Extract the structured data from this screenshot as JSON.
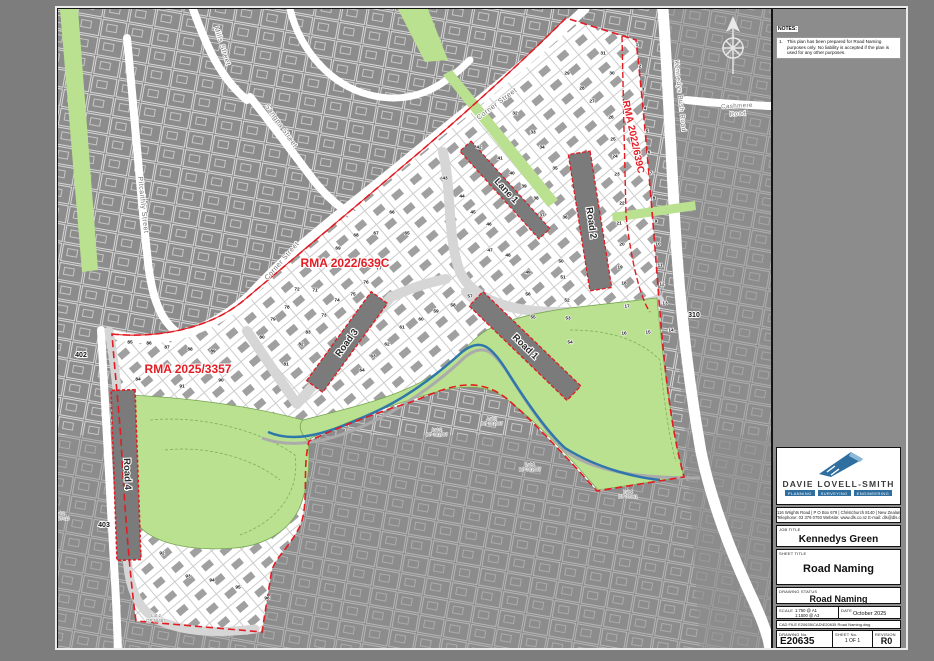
{
  "sheet": {
    "notes_label": "NOTES:",
    "note_number": "1.",
    "note_text": "This plan has been prepared for Road Naming purposes only. No liability is accepted if the plan is used for any other purposes.",
    "title_block": {
      "company": "DAVIE LOVELL-SMITH",
      "disciplines": [
        "PLANNING",
        "SURVEYING",
        "ENGINEERING"
      ],
      "address_line1": "116 Wrights Road  |  P O Box 679  |  Christchurch 8140  |  New Zealand",
      "address_line2": "Telephone: 03 379 0793   Website: www.dls.co.nz   E-mail: dls@dls.co.nz",
      "job_title_label": "JOB TITLE",
      "job_title": "Kennedys Green",
      "sheet_title_label": "SHEET TITLE",
      "sheet_title": "Road Naming",
      "drawing_status_label": "DRAWING STATUS",
      "drawing_status": "Road Naming",
      "scale_label": "SCALE",
      "scale_a1": "1:750 @ A1",
      "scale_a3": "1:1500 @ A3",
      "date_label": "DATE",
      "date": "October 2025",
      "cad_file_label": "CAD FILE",
      "cad_file": "E20635\\CAD\\E20635 Road Naming.dwg",
      "drawing_no_label": "DRAWING No.",
      "drawing_no": "E20635",
      "sheet_no_label": "SHEET No.",
      "sheet_no": "1 OF 1",
      "revision_label": "REVISION",
      "revision": "R0"
    }
  },
  "colors": {
    "reserve_green": "#b9e18f",
    "rma_red": "#e31b23",
    "stream_blue": "#2f76ab",
    "existing_gray": "#8c8c8c",
    "new_road_gray": "#d6d6d6",
    "named_road_gray": "#7b7b7b"
  },
  "map": {
    "road_labels": [
      {
        "text": "Road 1",
        "x": 525,
        "y": 347,
        "rot": 44
      },
      {
        "text": "Road 2",
        "x": 591,
        "y": 223,
        "rot": 82
      },
      {
        "text": "Road 3",
        "x": 347,
        "y": 343,
        "rot": -54
      },
      {
        "text": "Road 4",
        "x": 127,
        "y": 474,
        "rot": 88
      },
      {
        "text": "Lane 1",
        "x": 506,
        "y": 191,
        "rot": 47
      }
    ],
    "street_labels": [
      {
        "text": "Mills Street",
        "x": 222,
        "y": 46,
        "rot": 72,
        "size": 7
      },
      {
        "text": "Pitcaithly Street",
        "x": 143,
        "y": 205,
        "rot": 84,
        "size": 7
      },
      {
        "text": "Sangpa Street",
        "x": 281,
        "y": 126,
        "rot": 55,
        "size": 7
      },
      {
        "text": "Corner Street",
        "x": 497,
        "y": 104,
        "rot": -37,
        "size": 7
      },
      {
        "text": "Corner Street",
        "x": 282,
        "y": 261,
        "rot": -49,
        "size": 7
      },
      {
        "text": "Kennedys Bush Road",
        "x": 680,
        "y": 96,
        "rot": 84,
        "size": 6.5
      },
      {
        "text": "Cashmere",
        "x": 737,
        "y": 106,
        "rot": -3,
        "size": 6
      },
      {
        "text": "Road",
        "x": 738,
        "y": 114,
        "rot": -3,
        "size": 6
      }
    ],
    "rma_labels": [
      {
        "text": "RMA 2022/639C",
        "x": 345,
        "y": 264,
        "rot": 0,
        "size": 12
      },
      {
        "text": "RMA 2022/639C",
        "x": 633,
        "y": 137,
        "rot": 78,
        "size": 10
      },
      {
        "text": "RMA 2025/3357",
        "x": 188,
        "y": 370,
        "rot": 0,
        "size": 12
      }
    ],
    "area_labels": [
      {
        "text": "310",
        "x": 694,
        "y": 315
      },
      {
        "text": "402",
        "x": 81,
        "y": 355
      },
      {
        "text": "403",
        "x": 104,
        "y": 525
      }
    ],
    "parcel_labels": [
      {
        "l1": "Lot 2",
        "l2": "DP 57413",
        "x": 60,
        "y": 514
      },
      {
        "l1": "Lot 2",
        "l2": "DP 55487",
        "x": 156,
        "y": 616
      },
      {
        "l1": "Lot 2",
        "l2": "DP 301087",
        "x": 437,
        "y": 430
      },
      {
        "l1": "Lot 3",
        "l2": "DP 301087",
        "x": 492,
        "y": 419
      },
      {
        "l1": "Lot 1",
        "l2": "DP 301087",
        "x": 530,
        "y": 465
      },
      {
        "l1": "Lot 1",
        "l2": "DP 37961",
        "x": 628,
        "y": 492
      }
    ],
    "lot_numbers": [
      [
        1,
        637,
        44
      ],
      [
        2,
        640,
        66
      ],
      [
        3,
        643,
        89
      ],
      [
        4,
        645,
        108
      ],
      [
        5,
        647,
        131
      ],
      [
        6,
        649,
        152
      ],
      [
        7,
        651,
        173
      ],
      [
        8,
        654,
        198
      ],
      [
        9,
        656,
        221
      ],
      [
        10,
        658,
        244
      ],
      [
        11,
        660,
        265
      ],
      [
        12,
        662,
        284
      ],
      [
        13,
        665,
        303
      ],
      [
        14,
        671,
        330
      ],
      [
        15,
        648,
        332
      ],
      [
        16,
        624,
        333
      ],
      [
        17,
        627,
        306
      ],
      [
        18,
        624,
        283
      ],
      [
        19,
        620,
        267
      ],
      [
        20,
        622,
        244
      ],
      [
        21,
        619,
        223
      ],
      [
        22,
        622,
        203
      ],
      [
        23,
        617,
        174
      ],
      [
        24,
        615,
        156
      ],
      [
        25,
        613,
        139
      ],
      [
        26,
        611,
        117
      ],
      [
        27,
        592,
        101
      ],
      [
        28,
        582,
        88
      ],
      [
        29,
        567,
        73
      ],
      [
        30,
        612,
        73
      ],
      [
        31,
        603,
        53
      ],
      [
        32,
        515,
        113
      ],
      [
        33,
        533,
        132
      ],
      [
        34,
        542,
        147
      ],
      [
        35,
        555,
        168
      ],
      [
        36,
        565,
        217
      ],
      [
        37,
        542,
        215
      ],
      [
        38,
        536,
        198
      ],
      [
        39,
        524,
        186
      ],
      [
        40,
        512,
        173
      ],
      [
        41,
        500,
        158
      ],
      [
        42,
        479,
        147
      ],
      [
        43,
        445,
        178
      ],
      [
        44,
        462,
        196
      ],
      [
        45,
        473,
        212
      ],
      [
        46,
        489,
        224
      ],
      [
        47,
        490,
        250
      ],
      [
        48,
        508,
        255
      ],
      [
        49,
        528,
        272
      ],
      [
        50,
        561,
        261
      ],
      [
        51,
        563,
        277
      ],
      [
        52,
        567,
        300
      ],
      [
        53,
        568,
        318
      ],
      [
        54,
        570,
        342
      ],
      [
        55,
        533,
        317
      ],
      [
        56,
        528,
        294
      ],
      [
        57,
        470,
        296
      ],
      [
        58,
        453,
        305
      ],
      [
        59,
        436,
        311
      ],
      [
        60,
        421,
        319
      ],
      [
        61,
        402,
        327
      ],
      [
        62,
        387,
        344
      ],
      [
        63,
        373,
        356
      ],
      [
        64,
        362,
        370
      ],
      [
        65,
        407,
        233
      ],
      [
        66,
        392,
        212
      ],
      [
        67,
        376,
        233
      ],
      [
        68,
        356,
        235
      ],
      [
        69,
        338,
        248
      ],
      [
        70,
        323,
        263
      ],
      [
        71,
        315,
        290
      ],
      [
        72,
        297,
        289
      ],
      [
        73,
        324,
        315
      ],
      [
        74,
        337,
        300
      ],
      [
        75,
        353,
        294
      ],
      [
        76,
        366,
        282
      ],
      [
        77,
        379,
        268
      ],
      [
        78,
        287,
        307
      ],
      [
        79,
        273,
        319
      ],
      [
        80,
        262,
        337
      ],
      [
        81,
        286,
        364
      ],
      [
        82,
        301,
        344
      ],
      [
        83,
        308,
        332
      ],
      [
        84,
        138,
        379
      ],
      [
        85,
        130,
        342
      ],
      [
        86,
        149,
        343
      ],
      [
        87,
        167,
        347
      ],
      [
        88,
        190,
        349
      ],
      [
        89,
        213,
        351
      ],
      [
        90,
        221,
        380
      ],
      [
        91,
        182,
        386
      ],
      [
        92,
        162,
        553
      ],
      [
        93,
        188,
        576
      ],
      [
        94,
        212,
        580
      ],
      [
        95,
        238,
        587
      ],
      [
        96,
        267,
        598
      ]
    ]
  }
}
